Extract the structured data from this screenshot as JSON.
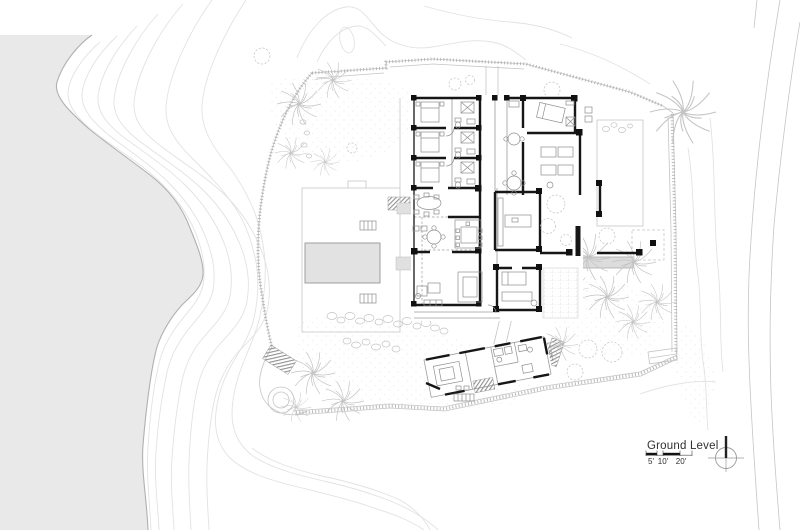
{
  "plan": {
    "title": "Ground Level",
    "scale_bar": {
      "tick_labels": [
        "5'",
        "10'",
        "20'"
      ]
    },
    "compass_icon": "north-arrow",
    "colors": {
      "background": "#ffffff",
      "water": "#e9e9e9",
      "shoreline": "#b0b0b0",
      "contours": "#e2e2e2",
      "site_lines": "#c5c5c5",
      "walls": "#161616",
      "furniture": "#8e8e8e",
      "vegetation": "#c3c3c3",
      "pool": "#e2e2e2",
      "canopy": "#dcdcdc",
      "text": "#2f2f2f"
    }
  }
}
